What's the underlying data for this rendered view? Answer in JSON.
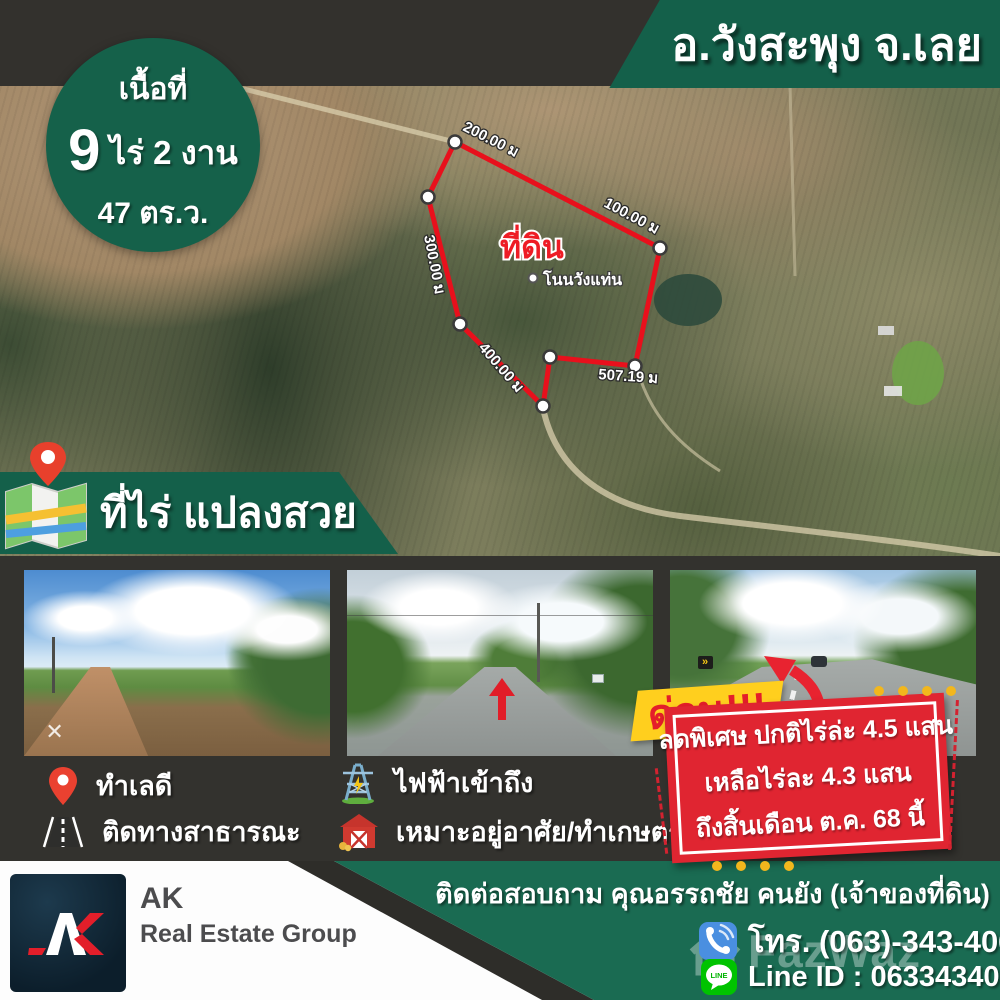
{
  "header": {
    "location_banner": "อ.วังสะพุง จ.เลย"
  },
  "area_badge": {
    "line1": "เนื้อที่",
    "number": "9",
    "unit_line": "ไร่ 2 งาน",
    "line3": "47 ตร.ว."
  },
  "map": {
    "plot_label": "ที่ดิน",
    "place_label": "โนนวังแท่น",
    "dimensions": [
      "200.00 ม",
      "100.00 ม",
      "300.00 ม",
      "400.00 ม",
      "507.19 ม"
    ]
  },
  "title_banner": {
    "text": "ที่ไร่ แปลงสวย"
  },
  "features": [
    {
      "icon": "pin-icon",
      "label": "ทำเลดี"
    },
    {
      "icon": "road-icon",
      "label": "ติดทางสาธารณะ"
    },
    {
      "icon": "pylon-icon",
      "label": "ไฟฟ้าเข้าถึง"
    },
    {
      "icon": "barn-icon",
      "label": "เหมาะอยู่อาศัย/ทำเกษตร"
    }
  ],
  "promo": {
    "ribbon": "ด่วน!!!",
    "lines": [
      "ลดพิเศษ ปกติไร่ล่ะ 4.5 แสน",
      "เหลือไร่ละ 4.3 แสน",
      "ถึงสิ้นเดือน ต.ค. 68 นี้"
    ]
  },
  "footer": {
    "brand_name": "AK",
    "brand_sub": "Real Estate Group",
    "contact_line": "ติดต่อสอบถาม คุณอรรถชัย  คนยัง (เจ้าของที่ดิน)",
    "phone": "โทร. (063)-343-4063",
    "line_id": "Line ID : 0633434063",
    "line_badge": "LINE",
    "watermark": "FazWaz"
  },
  "colors": {
    "brand_green": "#14604a",
    "bottom_green": "#1a6b52",
    "promo_red": "#e02531",
    "ribbon_yellow": "#ffcf1e",
    "plot_outline_red": "#e8101c",
    "background_dark": "#33312d"
  }
}
